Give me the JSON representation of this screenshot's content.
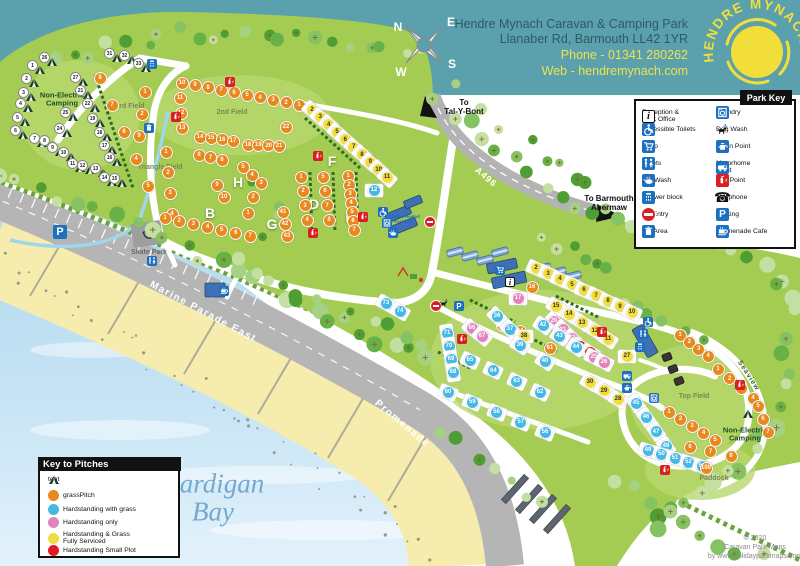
{
  "header": {
    "park_name": "Hendre Mynach Caravan & Camping Park",
    "address": "Llanaber Rd, Barmouth LL42 1YR",
    "phone": "Phone - 01341 280262",
    "web": "Web - hendremynach.com",
    "logo_text": "HENDRE MYNACH",
    "compass": {
      "n": "N",
      "e": "E",
      "s": "S",
      "w": "W"
    }
  },
  "park_key": {
    "title": "Park Key",
    "left": [
      {
        "icon": "reception",
        "label": "Reception &\nPark Office"
      },
      {
        "icon": "accessible",
        "label": "Accessible Toilets"
      },
      {
        "icon": "shop",
        "label": "Shop"
      },
      {
        "icon": "toilets",
        "label": "Toilets"
      },
      {
        "icon": "potwash",
        "label": "Pot Wash"
      },
      {
        "icon": "shower",
        "label": "Shower block"
      },
      {
        "icon": "noentry",
        "label": "No Entry"
      },
      {
        "icon": "bin",
        "label": "Bin Area"
      }
    ],
    "right": [
      {
        "icon": "laundry",
        "label": "Laundry"
      },
      {
        "icon": "dogwash",
        "label": "Dog Wash"
      },
      {
        "icon": "elsan",
        "label": "Elsan Point"
      },
      {
        "icon": "motorhome",
        "label": "Motorhome\nPoint"
      },
      {
        "icon": "fire",
        "label": "Fire Point"
      },
      {
        "icon": "phone",
        "label": "Telephone"
      },
      {
        "icon": "parking",
        "label": "Parking"
      },
      {
        "icon": "cafe",
        "label": "Promenade Cafe"
      }
    ]
  },
  "pitch_key": {
    "title": "Key to Pitches",
    "items": [
      {
        "icon": "tent",
        "label": "tent"
      },
      {
        "color": "#e8891d",
        "label": "grassPitch"
      },
      {
        "color": "#45b8e6",
        "label": "Hardstanding with grass"
      },
      {
        "color": "#e283bf",
        "label": "Hardstanding only"
      },
      {
        "color": "#f2dd3f",
        "label": "Hardstanding & Grass\nFully Serviced"
      },
      {
        "color": "#e01b22",
        "label": "Hardstanding Small Plot"
      }
    ]
  },
  "copyright": {
    "lines": [
      "© 2020",
      "Caravan Park Maps",
      "by www.holidayparkmaps.com"
    ]
  },
  "labels": [
    {
      "id": "non-electric-camping-left",
      "text": "Non-Electric\nCamping",
      "x": 62,
      "y": 100,
      "cls": "area"
    },
    {
      "id": "third-field",
      "text": "3rd Field",
      "x": 130,
      "y": 107,
      "cls": "field"
    },
    {
      "id": "second-field",
      "text": "2nd Field",
      "x": 232,
      "y": 113,
      "cls": "field"
    },
    {
      "id": "triangle-field",
      "text": "Triangle Field",
      "x": 160,
      "y": 168,
      "cls": "field"
    },
    {
      "id": "top-field",
      "text": "Top Field",
      "x": 694,
      "y": 397,
      "cls": "field"
    },
    {
      "id": "paddock",
      "text": "Paddock",
      "x": 714,
      "y": 479,
      "cls": "field"
    },
    {
      "id": "non-electric-camping-right",
      "text": "Non-Electric\nCamping",
      "x": 745,
      "y": 435,
      "cls": "area"
    },
    {
      "id": "skate-park",
      "text": "Skate Park",
      "x": 149,
      "y": 253,
      "cls": "gray"
    },
    {
      "id": "field-letter-h",
      "text": "H",
      "x": 238,
      "y": 183,
      "cls": "letter"
    },
    {
      "id": "field-letter-b",
      "text": "B",
      "x": 210,
      "y": 214,
      "cls": "letter"
    },
    {
      "id": "field-letter-g",
      "text": "G",
      "x": 272,
      "y": 225,
      "cls": "letter"
    },
    {
      "id": "field-letter-d",
      "text": "D",
      "x": 314,
      "y": 205,
      "cls": "letter"
    },
    {
      "id": "field-letter-e",
      "text": "E",
      "x": 350,
      "y": 218,
      "cls": "letter"
    },
    {
      "id": "field-letter-f",
      "text": "F",
      "x": 332,
      "y": 162,
      "cls": "letter"
    },
    {
      "id": "marine-parade-east",
      "text": "Marine Parade East",
      "x": 203,
      "y": 312,
      "rot": 28,
      "cls": "road"
    },
    {
      "id": "promenade",
      "text": "Promenade",
      "x": 402,
      "y": 424,
      "rot": 40,
      "cls": "road"
    },
    {
      "id": "a496",
      "text": "A496",
      "x": 486,
      "y": 177,
      "rot": 40,
      "cls": "roadnum"
    },
    {
      "id": "to-tal-y-bont",
      "text": "To\nTal-Y-Bont",
      "x": 464,
      "y": 108,
      "cls": "dest"
    },
    {
      "id": "to-barmouth-abermaw",
      "text": "To Barmouth\nAbermaw",
      "x": 609,
      "y": 204,
      "cls": "dest"
    },
    {
      "id": "seaview",
      "text": "Seaview",
      "x": 748,
      "y": 376,
      "rot": 57,
      "cls": "tiny"
    },
    {
      "id": "cardigan-bay",
      "text": "Cardigan\nBay",
      "x": 213,
      "y": 498,
      "cls": "sea"
    },
    {
      "id": "central-facilities",
      "text": "Central Heated\nFacilities",
      "x": 404,
      "y": 219,
      "cls": "micro"
    }
  ],
  "pitch_colors": {
    "g": "#e8891d",
    "b": "#45b8e6",
    "p": "#e283bf",
    "y": "#f2dd3f",
    "r": "#e01b22"
  },
  "pitches": [
    {
      "t": "g",
      "from": [
        100,
        78
      ],
      "to": [
        148,
        186
      ],
      "n": [
        8,
        7,
        6,
        4,
        5
      ]
    },
    {
      "t": "g",
      "from": [
        145,
        92
      ],
      "to": [
        139,
        136
      ],
      "n": [
        1,
        2,
        9
      ]
    },
    {
      "t": "g",
      "from": [
        166,
        152
      ],
      "to": [
        172,
        214
      ],
      "n": [
        1,
        2,
        3,
        4
      ]
    },
    {
      "t": "g",
      "from": [
        182,
        83
      ],
      "to": [
        299,
        105
      ],
      "n": [
        10,
        9,
        8,
        7,
        6,
        5,
        4,
        3,
        2,
        1
      ]
    },
    {
      "t": "g",
      "from": [
        180,
        98
      ],
      "to": [
        182,
        128
      ],
      "n": [
        11,
        12,
        13
      ]
    },
    {
      "t": "g",
      "from": [
        200,
        137
      ],
      "to": [
        233,
        141
      ],
      "n": [
        14,
        15,
        16,
        17
      ]
    },
    {
      "t": "g",
      "from": [
        248,
        145
      ],
      "to": [
        279,
        146
      ],
      "n": [
        18,
        19,
        20,
        21
      ]
    },
    {
      "t": "g",
      "from": [
        286,
        127
      ],
      "to": [
        286,
        127
      ],
      "n": [
        22
      ]
    },
    {
      "t": "g",
      "from": [
        199,
        155
      ],
      "to": [
        222,
        160
      ],
      "n": [
        8,
        7,
        6
      ]
    },
    {
      "t": "g",
      "from": [
        243,
        167
      ],
      "to": [
        261,
        183
      ],
      "n": [
        5,
        4,
        3
      ]
    },
    {
      "t": "g",
      "from": [
        253,
        197
      ],
      "to": [
        248,
        213
      ],
      "n": [
        2,
        1
      ]
    },
    {
      "t": "g",
      "from": [
        217,
        185
      ],
      "to": [
        224,
        197
      ],
      "n": [
        9,
        10
      ]
    },
    {
      "t": "g",
      "from": [
        165,
        218
      ],
      "to": [
        250,
        236
      ],
      "n": [
        1,
        2,
        3,
        4,
        5,
        6,
        7
      ]
    },
    {
      "t": "g",
      "from": [
        283,
        212
      ],
      "to": [
        287,
        236
      ],
      "n": [
        41,
        42,
        43
      ]
    },
    {
      "t": "g",
      "from": [
        301,
        177
      ],
      "to": [
        307,
        220
      ],
      "n": [
        1,
        2,
        3,
        4
      ]
    },
    {
      "t": "g",
      "from": [
        323,
        177
      ],
      "to": [
        329,
        220
      ],
      "n": [
        5,
        6,
        7,
        8
      ]
    },
    {
      "t": "g",
      "from": [
        348,
        176
      ],
      "to": [
        354,
        230
      ],
      "n": [
        1,
        2,
        3,
        4,
        5,
        6,
        7
      ]
    },
    {
      "t": "y",
      "from": [
        312,
        110
      ],
      "to": [
        387,
        177
      ],
      "n": [
        2,
        3,
        4,
        5,
        6,
        7,
        8,
        9,
        10,
        11
      ]
    },
    {
      "t": "b",
      "from": [
        374,
        190
      ],
      "to": [
        374,
        190
      ],
      "n": [
        12
      ]
    },
    {
      "t": "b",
      "from": [
        386,
        303
      ],
      "to": [
        400,
        311
      ],
      "n": [
        73,
        74
      ]
    },
    {
      "t": "y",
      "from": [
        536,
        268
      ],
      "to": [
        632,
        312
      ],
      "n": [
        2,
        3,
        4,
        5,
        6,
        7,
        8,
        9,
        10
      ]
    },
    {
      "t": "y",
      "from": [
        608,
        339
      ],
      "to": [
        556,
        306
      ],
      "n": [
        11,
        12,
        13,
        14,
        15
      ]
    },
    {
      "t": "p",
      "from": [
        518,
        298
      ],
      "to": [
        518,
        298
      ],
      "n": [
        17
      ]
    },
    {
      "t": "p",
      "from": [
        554,
        321
      ],
      "to": [
        572,
        338
      ],
      "n": [
        20,
        21,
        22
      ]
    },
    {
      "t": "r",
      "from": [
        580,
        346
      ],
      "to": [
        590,
        352
      ],
      "n": [
        23,
        24
      ]
    },
    {
      "t": "p",
      "from": [
        594,
        357
      ],
      "to": [
        604,
        362
      ],
      "n": [
        25,
        26
      ]
    },
    {
      "t": "g",
      "from": [
        532,
        287
      ],
      "to": [
        532,
        287
      ],
      "n": [
        16
      ]
    },
    {
      "t": "g",
      "from": [
        502,
        325
      ],
      "to": [
        520,
        331
      ],
      "n": [
        35,
        34
      ]
    },
    {
      "t": "g",
      "from": [
        550,
        348
      ],
      "to": [
        550,
        348
      ],
      "n": [
        61
      ]
    },
    {
      "t": "p",
      "from": [
        472,
        328
      ],
      "to": [
        482,
        336
      ],
      "n": [
        66,
        67
      ]
    },
    {
      "t": "b",
      "from": [
        447,
        333
      ],
      "to": [
        453,
        372
      ],
      "n": [
        71,
        70,
        69,
        68
      ]
    },
    {
      "t": "b",
      "from": [
        497,
        316
      ],
      "to": [
        510,
        329
      ],
      "n": [
        36,
        37
      ]
    },
    {
      "t": "y",
      "from": [
        524,
        336
      ],
      "to": [
        524,
        336
      ],
      "n": [
        38
      ]
    },
    {
      "t": "b",
      "from": [
        520,
        345
      ],
      "to": [
        545,
        361
      ],
      "n": [
        39,
        40
      ]
    },
    {
      "t": "b",
      "from": [
        543,
        325
      ],
      "to": [
        576,
        347
      ],
      "n": [
        42,
        43,
        44
      ]
    },
    {
      "t": "b",
      "from": [
        470,
        360
      ],
      "to": [
        540,
        392
      ],
      "n": [
        65,
        64,
        63,
        62
      ]
    },
    {
      "t": "b",
      "from": [
        448,
        392
      ],
      "to": [
        545,
        432
      ],
      "n": [
        60,
        59,
        58,
        57,
        56
      ]
    },
    {
      "t": "b",
      "from": [
        636,
        403
      ],
      "to": [
        666,
        446
      ],
      "n": [
        45,
        46,
        47,
        48
      ]
    },
    {
      "t": "b",
      "from": [
        648,
        450
      ],
      "to": [
        702,
        466
      ],
      "n": [
        49,
        50,
        51,
        52,
        53
      ]
    },
    {
      "t": "y",
      "from": [
        590,
        382
      ],
      "to": [
        618,
        399
      ],
      "n": [
        30,
        29,
        28
      ]
    },
    {
      "t": "y",
      "from": [
        627,
        356
      ],
      "to": [
        627,
        356
      ],
      "n": [
        27
      ]
    },
    {
      "t": "g",
      "from": [
        680,
        335
      ],
      "to": [
        708,
        356
      ],
      "n": [
        1,
        2,
        3,
        4
      ]
    },
    {
      "t": "g",
      "from": [
        718,
        369
      ],
      "to": [
        753,
        398
      ],
      "n": [
        1,
        2,
        3,
        4
      ]
    },
    {
      "t": "g",
      "from": [
        758,
        406
      ],
      "to": [
        768,
        432
      ],
      "n": [
        5,
        6,
        7
      ]
    },
    {
      "t": "g",
      "from": [
        669,
        412
      ],
      "to": [
        715,
        440
      ],
      "n": [
        1,
        2,
        3,
        4,
        5
      ]
    },
    {
      "t": "g",
      "from": [
        690,
        447
      ],
      "to": [
        731,
        456
      ],
      "n": [
        6,
        7,
        8
      ]
    },
    {
      "t": "g",
      "from": [
        706,
        468
      ],
      "to": [
        706,
        468
      ],
      "n": [
        100
      ]
    }
  ],
  "tents": [
    [
      26,
      52,
      62
    ],
    [
      31,
      117,
      58
    ],
    [
      32,
      132,
      60
    ],
    [
      33,
      146,
      68
    ],
    [
      1,
      40,
      70
    ],
    [
      2,
      34,
      83
    ],
    [
      3,
      31,
      97
    ],
    [
      4,
      28,
      108
    ],
    [
      5,
      25,
      122
    ],
    [
      6,
      23,
      135
    ],
    [
      7,
      42,
      143
    ],
    [
      8,
      52,
      145
    ],
    [
      9,
      60,
      152
    ],
    [
      10,
      71,
      157
    ],
    [
      11,
      80,
      168
    ],
    [
      12,
      90,
      170
    ],
    [
      13,
      103,
      173
    ],
    [
      14,
      112,
      182
    ],
    [
      15,
      122,
      183
    ],
    [
      27,
      83,
      82
    ],
    [
      21,
      88,
      95
    ],
    [
      22,
      95,
      108
    ],
    [
      25,
      73,
      117
    ],
    [
      19,
      100,
      123
    ],
    [
      24,
      67,
      133
    ],
    [
      18,
      107,
      137
    ],
    [
      17,
      112,
      150
    ],
    [
      16,
      117,
      162
    ],
    [
      0,
      748,
      414
    ]
  ],
  "facilities": [
    {
      "i": "fire",
      "x": 176,
      "y": 117
    },
    {
      "i": "fire",
      "x": 230,
      "y": 82
    },
    {
      "i": "fire",
      "x": 318,
      "y": 156
    },
    {
      "i": "fire",
      "x": 313,
      "y": 233
    },
    {
      "i": "fire",
      "x": 363,
      "y": 217
    },
    {
      "i": "fire",
      "x": 602,
      "y": 332
    },
    {
      "i": "fire",
      "x": 462,
      "y": 339
    },
    {
      "i": "fire",
      "x": 665,
      "y": 470
    },
    {
      "i": "fire",
      "x": 740,
      "y": 385
    },
    {
      "i": "noentry",
      "x": 430,
      "y": 222
    },
    {
      "i": "noentry",
      "x": 436,
      "y": 306
    },
    {
      "i": "parking",
      "x": 60,
      "y": 232
    },
    {
      "i": "parking",
      "x": 459,
      "y": 306
    },
    {
      "i": "dogwash",
      "x": 444,
      "y": 303
    },
    {
      "i": "toilets",
      "x": 152,
      "y": 261
    },
    {
      "i": "toilets",
      "x": 643,
      "y": 334
    },
    {
      "i": "shower",
      "x": 152,
      "y": 64
    },
    {
      "i": "shower",
      "x": 640,
      "y": 347
    },
    {
      "i": "accessible",
      "x": 383,
      "y": 212
    },
    {
      "i": "accessible",
      "x": 648,
      "y": 322
    },
    {
      "i": "laundry",
      "x": 387,
      "y": 223
    },
    {
      "i": "laundry",
      "x": 654,
      "y": 398
    },
    {
      "i": "motorhome",
      "x": 627,
      "y": 376
    },
    {
      "i": "elsan",
      "x": 627,
      "y": 388
    },
    {
      "i": "bin",
      "x": 149,
      "y": 128
    },
    {
      "i": "cafe",
      "x": 224,
      "y": 291
    },
    {
      "i": "shop",
      "x": 500,
      "y": 270
    },
    {
      "i": "reception",
      "x": 510,
      "y": 282
    },
    {
      "i": "potwash",
      "x": 393,
      "y": 233
    },
    {
      "i": "skate",
      "x": 147,
      "y": 235
    }
  ]
}
